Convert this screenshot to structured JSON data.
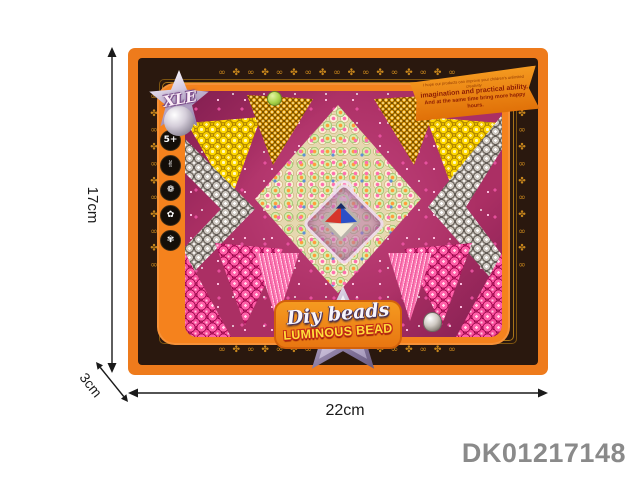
{
  "annotations": {
    "height_label": "17cm",
    "depth_label": "3cm",
    "width_label": "22cm",
    "product_code": "DK01217148"
  },
  "box": {
    "brand_logo_text": "XLE",
    "feature_icons": [
      {
        "name": "age-badge-icon",
        "glyph": "5+"
      },
      {
        "name": "hand-skill-icon",
        "glyph": "✌"
      },
      {
        "name": "brain-icon",
        "glyph": "❁"
      },
      {
        "name": "creativity-icon",
        "glyph": "✿"
      },
      {
        "name": "sparkle-hand-icon",
        "glyph": "✾"
      }
    ]
  },
  "ribbon": {
    "line1": "I hope our products can improve your children's unlimited creativity",
    "line2": "imagination and practical ability.",
    "line3": "And at the same time bring more happy hours."
  },
  "footer_logo": {
    "script_text": "Diy beads",
    "block_text": "LUMINOUS BEAD"
  },
  "ornament": {
    "motif_row": "∞ ✤ ∞ ✤ ∞ ✤ ∞ ✤ ∞ ✤ ∞ ✤ ∞ ✤ ∞ ✤ ∞",
    "motif_col": "∞ ✤ ∞ ✤ ∞ ✤ ∞ ✤ ∞ ✤ ∞"
  },
  "colors": {
    "outer_frame": "#ee7b1c",
    "dark_band": "#2a180e",
    "gold": "#c9871c",
    "tray_bg": "#ab2f64",
    "yellow_bead": "#ffd800",
    "gold_bead": "#e29d12",
    "silver_bead": "#cfc9c2",
    "pink_bead": "#ff5fa8",
    "pastel_bead": "#faf0d6",
    "pendant_red": "#d6352b",
    "pendant_blue": "#2b4fc7",
    "code_gray": "#8a8a8a"
  }
}
